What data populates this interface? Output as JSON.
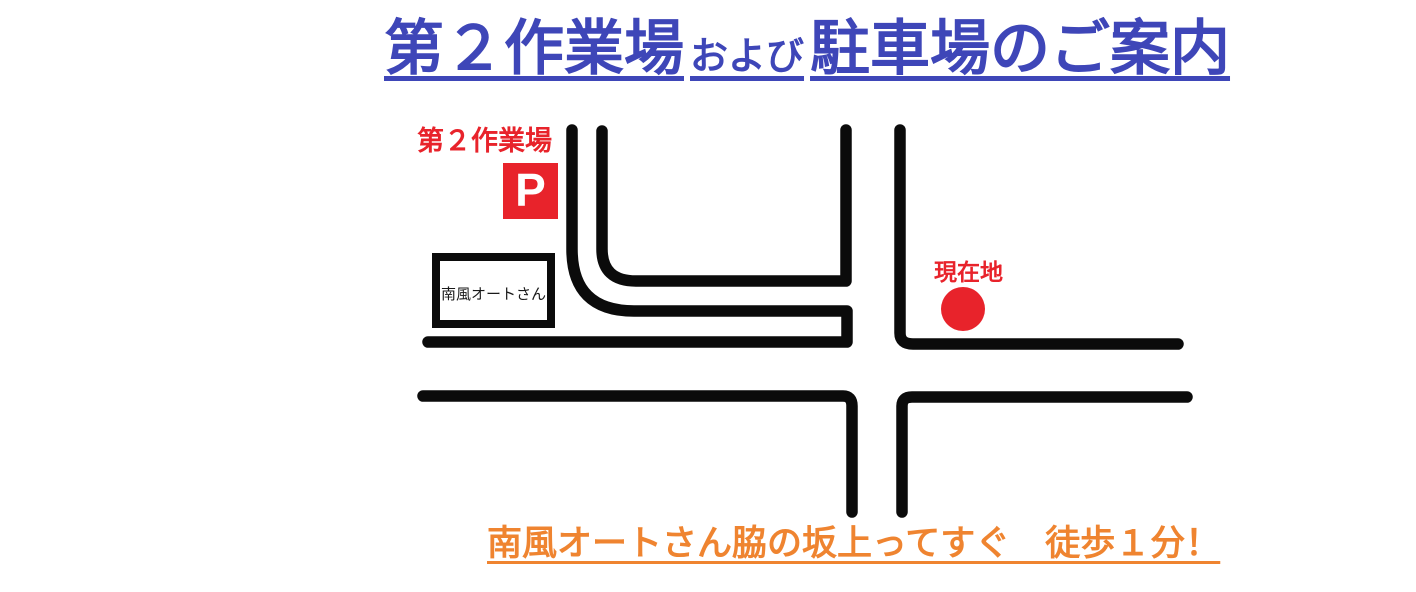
{
  "title": {
    "main_part": "第２作業場",
    "connector": "および",
    "second_part": "駐車場のご案内"
  },
  "map": {
    "workshop_label": "第２作業場",
    "parking_marker": "P",
    "building_name": "南風オートさん",
    "current_location": "現在地"
  },
  "footer": {
    "directions": "南風オートさん脇の坂上ってすぐ　徒歩１分！"
  },
  "colors": {
    "title_blue": "#3E46B8",
    "accent_red": "#E8232B",
    "directions_orange": "#EF8430",
    "road_black": "#0B0B0B"
  }
}
